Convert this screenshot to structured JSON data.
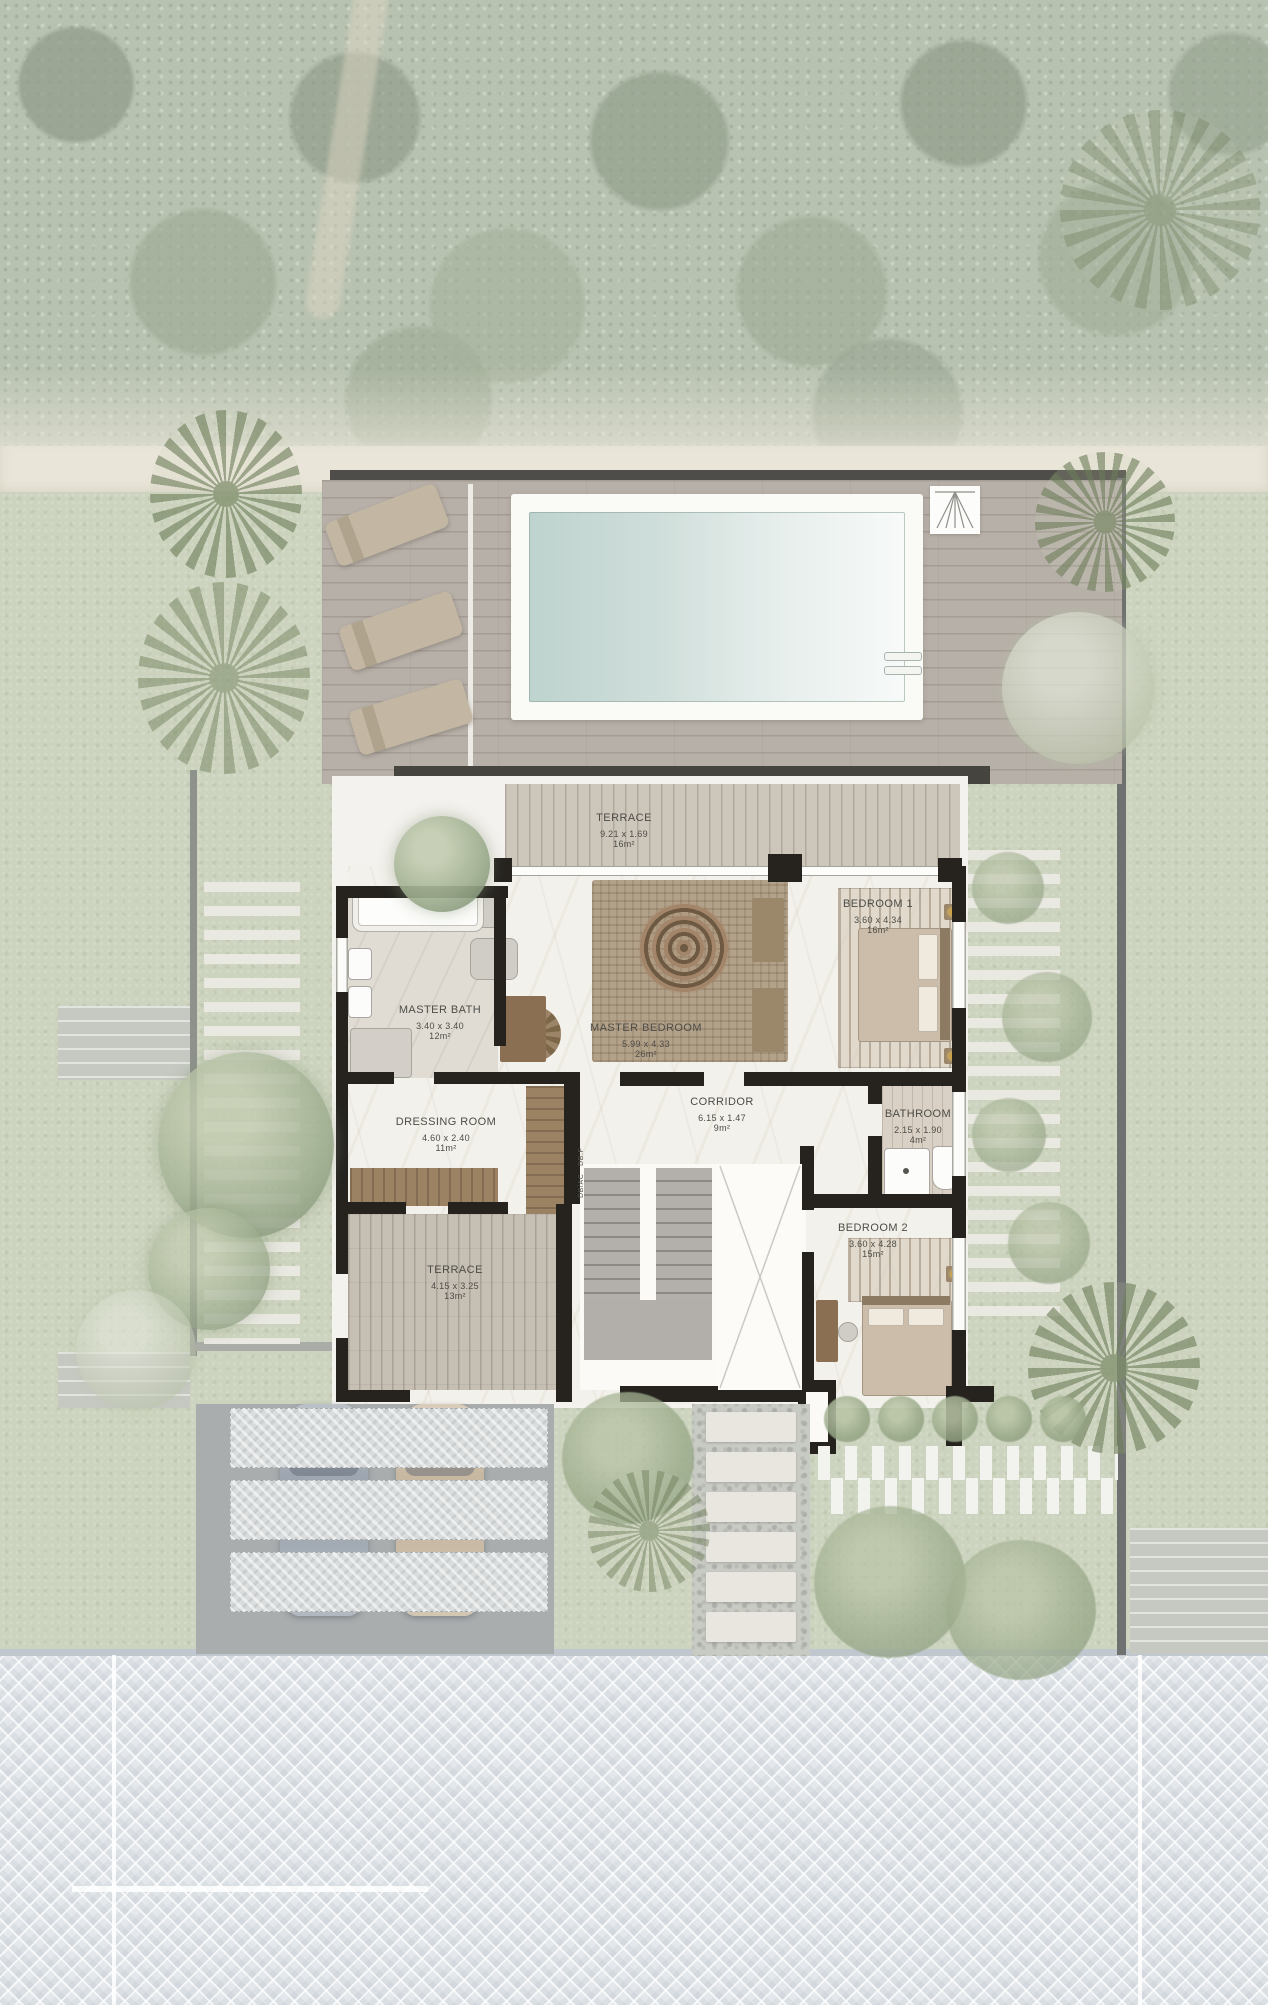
{
  "plan": {
    "rooms": [
      {
        "id": "terrace_top",
        "name": "TERRACE",
        "dims": "9.21 x 1.69",
        "area": "16m²"
      },
      {
        "id": "master_bedroom",
        "name": "MASTER BEDROOM",
        "dims": "5.99 x 4.33",
        "area": "26m²"
      },
      {
        "id": "master_bath",
        "name": "MASTER BATH",
        "dims": "3.40 x 3.40",
        "area": "12m²"
      },
      {
        "id": "bedroom_1",
        "name": "BEDROOM 1",
        "dims": "3.60 x 4.34",
        "area": "16m²"
      },
      {
        "id": "corridor",
        "name": "CORRIDOR",
        "dims": "6.15 x 1.47",
        "area": "9m²"
      },
      {
        "id": "bathroom",
        "name": "BATHROOM",
        "dims": "2.15 x 1.90",
        "area": "4m²"
      },
      {
        "id": "dressing_room",
        "name": "DRESSING ROOM",
        "dims": "4.60 x 2.40",
        "area": "11m²"
      },
      {
        "id": "terrace_bottom",
        "name": "TERRACE",
        "dims": "4.15 x 3.25",
        "area": "13m²"
      },
      {
        "id": "bedroom_2",
        "name": "BEDROOM 2",
        "dims": "3.60 x 4.28",
        "area": "15m²"
      }
    ],
    "utility_label": "DB/AC   DB.F",
    "colors": {
      "pool_water": "#bed3ce",
      "deck_wood": "#b7b0a8",
      "grass": "#ccd3be",
      "forest": "#93a287",
      "road_pavers": "#e4e8ec",
      "walls": "#26231f",
      "terrace_wood": "#cdc6bb",
      "label_text": "#4d4c47"
    }
  }
}
